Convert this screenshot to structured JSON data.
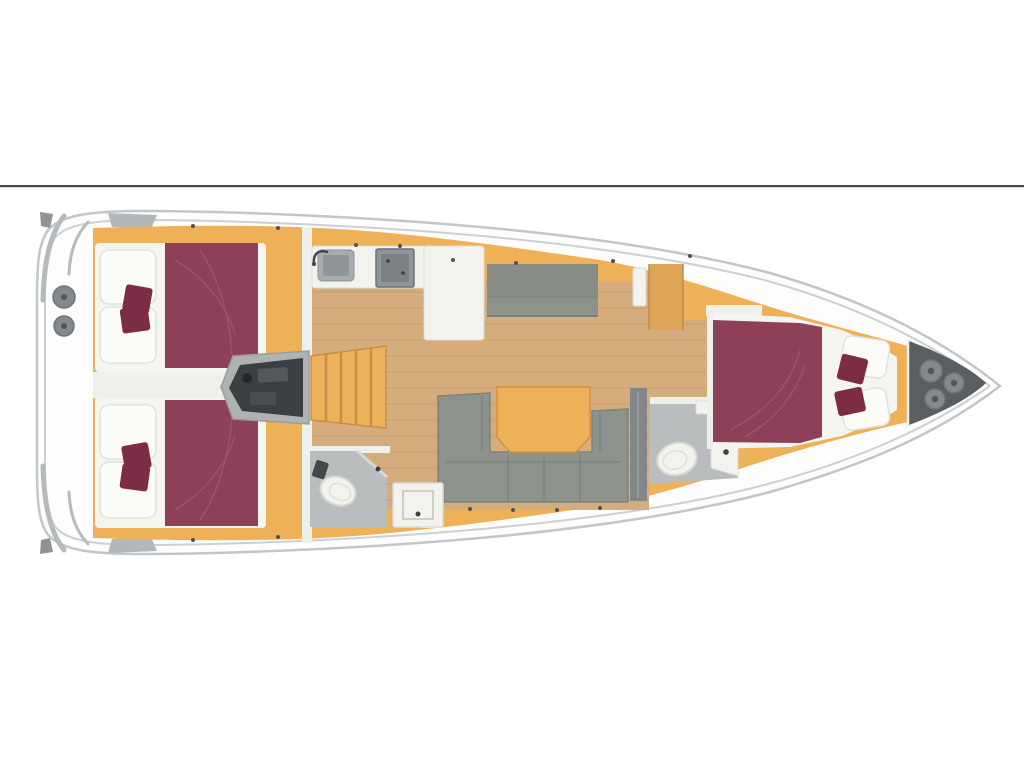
{
  "page": {
    "background": "#ffffff",
    "divider_color": "#474747"
  },
  "floorplan": {
    "subject": "sailboat-interior-deck-plan",
    "orientation": "bow-right-stern-left",
    "regions": [
      "stern-swim-platform",
      "aft-cabin-port",
      "aft-cabin-starboard",
      "engine-compartment",
      "companionway-stairs",
      "galley",
      "settee",
      "wardrobe",
      "salon-sofa",
      "salon-table",
      "forward-head",
      "shower-tray",
      "aft-head",
      "owner-cabin",
      "anchor-locker"
    ],
    "counts": {
      "double_beds": 3,
      "toilets": 2,
      "sinks": 1,
      "stoves": 1,
      "bow-deck-hatches": 3,
      "stern-deck-hatches": 2
    }
  },
  "palette": {
    "divider": "#474747",
    "hull_fill": "#fdfdfd",
    "hull_stroke": "#c2c6c8",
    "deck_line": "#cdd0d2",
    "transom_gray": "#b6babc",
    "notch_gray": "#8e9396",
    "step_gray": "#b3b7b9",
    "cabinetry": "#eeb158",
    "cabinetry_dark": "#dda456",
    "stair_fill": "#edb15c",
    "stair_line": "#c78e45",
    "floor_wood": "#d5ac7c",
    "floor_plank": "#c0935e",
    "wall_white": "#eef0ec",
    "bed_base": "#f4f4f0",
    "pillow": "#fbfbf8",
    "pillow_stroke": "#e2e2dc",
    "mattress": "#8e4058",
    "cushion": "#7c2d45",
    "blanket_fold": "#a25a74",
    "sofa": "#8d938c",
    "sofa_seam": "#767c75",
    "bath_floor": "#b9bdbe",
    "fixture": "#f2f2ee",
    "fixture_stroke": "#d8d8d2",
    "appliance": "#8f9598",
    "appliance_dark": "#7b8184",
    "sink_rim": "#a7acae",
    "engine": "#3b3f42",
    "engine_housing": "#aeb3b2",
    "locker_dark": "#5a5e61",
    "hatch": "#85898b",
    "hatch_ring": "#6e7376",
    "hatch_dot": "#54585a",
    "table_stroke": "#d0923f",
    "detail_dot": "#55504a",
    "metal_dark": "#45494b",
    "knob_dark": "#3c4042",
    "fridge_gray": "#82878a"
  }
}
